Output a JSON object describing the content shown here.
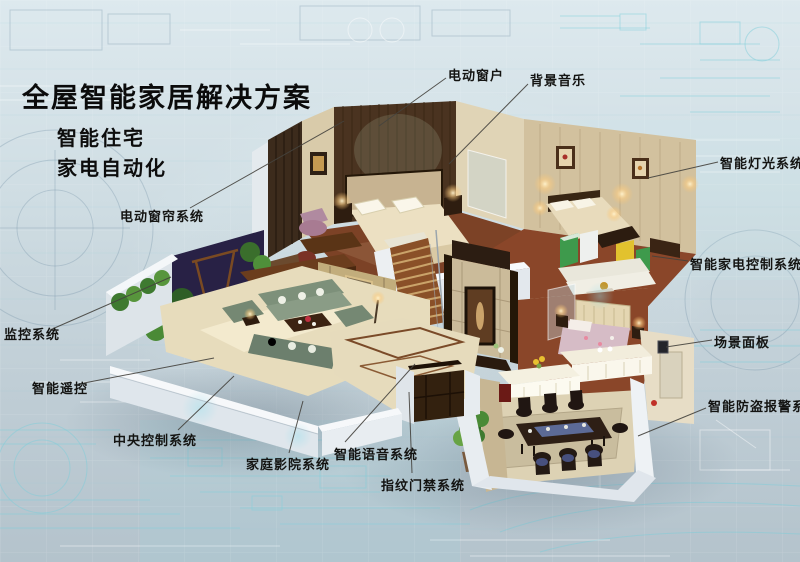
{
  "title": "全屋智能家居解决方案",
  "subtitle": {
    "line1": "智能住宅",
    "line2": "家电自动化"
  },
  "labels": {
    "electric_window": "电动窗户",
    "background_music": "背景音乐",
    "smart_lighting_system": "智能灯光系统",
    "smart_appliance_control_system": "智能家电控制系统",
    "scene_panel": "场景面板",
    "smart_antitheft_alarm_system": "智能防盗报警系统",
    "electric_curtain_system": "电动窗帘系统",
    "monitoring_system": "监控系统",
    "smart_remote_control": "智能遥控",
    "central_control_system": "中央控制系统",
    "home_theater_system": "家庭影院系统",
    "smart_voice_system": "智能语音系统",
    "fingerprint_access_system": "指纹门禁系统"
  },
  "colors": {
    "background_top": "#dde9ee",
    "background_bottom": "#b4c3cc",
    "blueprint_cyan": "#7fd2dc",
    "title_text": "#0b0b0b",
    "leader_line": "#45433e",
    "wood_floor": "#8a4629",
    "cutaway_wall_white": "#e7ecf0"
  }
}
